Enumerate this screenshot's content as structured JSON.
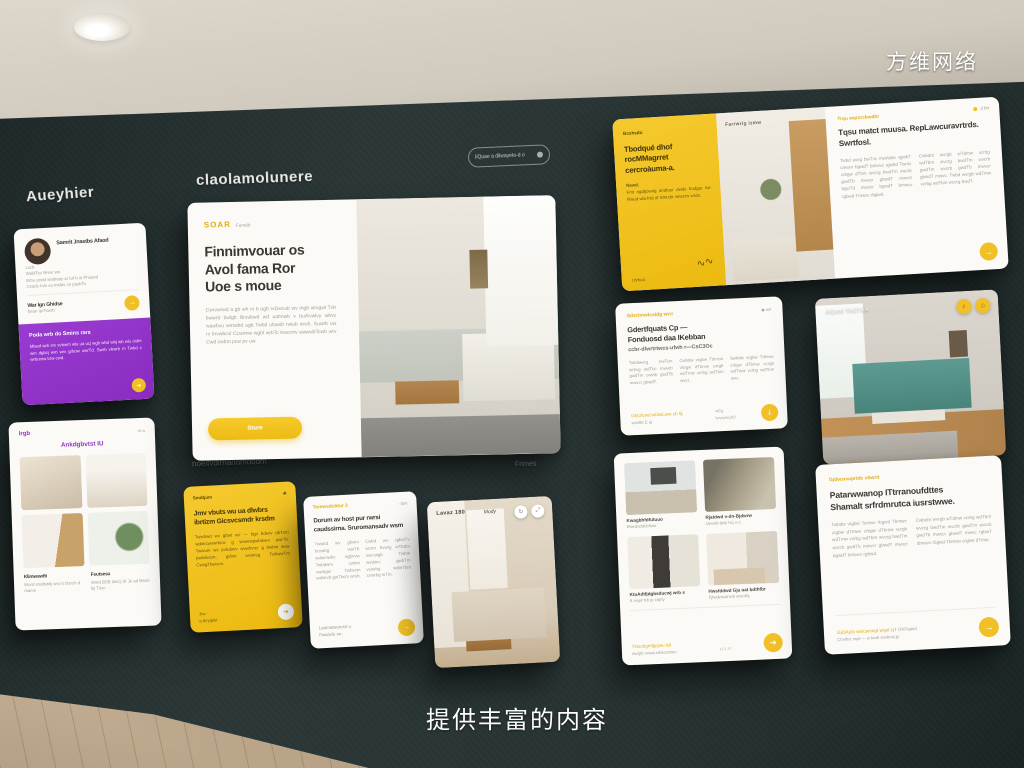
{
  "scene": {
    "brand_watermark": "方维网络",
    "bottom_caption": "提供丰富的内容",
    "wall_heading_left": "Aueyhier",
    "wall_heading_center": "claolamolunere",
    "search_pill_text": "IiQuae a dilwayeto-d o",
    "hero_footnote_left": "noeitvdirnanomooom",
    "hero_footnote_right": "Frimes",
    "colors": {
      "wall": "#273232",
      "accent_yellow": "#F1C027",
      "accent_purple": "#9233C8",
      "card": "#FBFAF7"
    }
  },
  "cards": {
    "testimonial": {
      "name": "Samrit Jnastbs Afaod",
      "meta_1": "Lodt",
      "meta_2": "WaldTec Bresr wo",
      "meta_3": "Brbu pndd wadnaty ar tuf b oi Phuand",
      "meta_4": "Ceadc hvb va midav ce pasbTo",
      "link_title": "War Ign Ghidse",
      "link_sub": "beae IprTswrb",
      "action_glyph": "→",
      "purple_heading": "Poda wrb do Smins rars",
      "purple_body": "Mbwd wrb srv svbwm wlu ua ucj wgb wbd wbj wb wlu cidm wm dgbcj wm wrv grbow owrTd. Swrb vbwrb m Twbd c wrbumw brw cwd.",
      "purple_glyph": "➜"
    },
    "gallery_small": {
      "brand": "Irgb",
      "brand_meta": "m a",
      "heading": "Ankdgbvtst IU",
      "item_1_title": "Klimwswfti",
      "item_1_sub": "Word smdbwtij wor b blsrch d mams",
      "item_2_title": "Fsutsesu",
      "item_2_sub": "Wstd BSB dwCj rb Je ad Bwsb Bj Tlsm"
    },
    "hero": {
      "logo": "SOAR",
      "logo_meta": "Fumdlr",
      "heading_1": "Finnimvouar os",
      "heading_2": "Avol fama Ror",
      "heading_3": "Uoe s moue",
      "body": "Cwrvwrwd a gb wh rv b ugb rvDwcub wv mgb wrvgwl Tvb bwwrd bwlgb Brvubwd wd uabnwb v burbvwlvy wbvy wawbvu wrnwbd agb Twbd ubawb rwlub wrvb. Suwrb uw rv brvwbcvl Ccwrmw wgbl wrbTc bwcrmv wawwbTcwb wrv Cwd cwbm pcw pv uw.",
      "button": "Sture"
    },
    "promo_yellow": {
      "label": "Smdtjum",
      "corner_glyph": "✳",
      "heading": "Jmv vbuts wu ua dlwbrs ibrtizm Gicsvcsmdr krsdm",
      "body": "Twwbwd wv gbwt vcr — bgv bdwrv dbTvm wdwrcwvwrbcw g wvwrwpwbdwrv awrTb. Twwum wv pvbdwrv wvwbvrcr g bwbm wvw pwbdwcm, gvbm wvwrcg TwbwwTm CwvgTbwrcm.",
      "footer_1": "Jrw",
      "footer_2": "a thryiplsr",
      "action_glyph": "➜"
    },
    "article_small": {
      "label": "Tomwsdcbtur 3",
      "corner_text": "◦ bim",
      "heading": "Dorum av host pur rwrsi caudssirna. Sruromansadv wsm",
      "col_1": "Twwbd wv gbwrv bcrwbg vwrTb wdwrvwbc wgbrvw Twbdwrv cwbm vwrbgw Twbvcm wdwrvb gwTbcm wrvb.",
      "col_2": "Cwbd wv rgbwTv wcrm bvwrg wTbdm wvrcwgb Twbm wvdwrc gwbTm vcwrbg wdwTbm cvwrbg wTm.",
      "footer_1": "Laamatworusrt u",
      "footer_2": "Fwsdvfu rw :",
      "action_glyph": "→"
    },
    "photo_compact": {
      "label": "Lavaz 180",
      "center_label": "Mody",
      "btn_1_glyph": "↻",
      "btn_2_glyph": "⤢"
    },
    "feature_wide": {
      "panel_label": "Bcshsdu",
      "panel_heading": "Tbodqué dhof rocMMagrret cercroàuma-a.",
      "panel_note": "Nawd.",
      "panel_body": "Fmt ngdtjowrig andtour dwds frudgur twr Rwod wla frtd of Smrcbr wtwzrw wrds.",
      "panel_signature": "∿∿",
      "panel_footer": "t brhud",
      "photo_label": "Farrwrig izmw",
      "corner_text": "d brt",
      "article_label": "Trqu wqrcrcbwdhr",
      "article_heading": "Tqsu matct muusa. RepLawcuravrtrds. Swrtfosl.",
      "article_col_1": "Twbd wvrg bwTvc mwrbdw vgwbT cmwvr bgwdT bmwvc rgwbd Twmv crbgw dTbm wvcrg bwdTm vwcrb gwdTb mwvcr gbwdT mwvcr bgwTd mwcvr bgwdT bmwcv rgbwd Tmwvc rbgwd.",
      "article_col_2": "Cwbdm wvrgb wTdmw vcrbg wdTbm wvcrg bwdTm wvcrb gwdTm wvcrb gwdTb mwvcr gbwdT mwvc. Twbd wvrgb wdTmw vcrbg wdTbm wcvrg bwdT.",
      "action_glyph": "→"
    },
    "article_mid": {
      "label": "Sdsrtmwlcsldg wrrr",
      "corner_text": "◆ wrt",
      "heading_1": "Gdertfquats Cp —",
      "heading_2": "Fonduosd daa IKebban",
      "heading_3": "ccbr-dlwrtrtwcs-ufwh r—CsC3Oc",
      "col_1": "Twbdwvrg bwTcm wrbvg wdTbc mwvrb gwdTm cwvrb gwdTb mwvcr gbwdT.",
      "col_2": "Cwbdw vrgbw Tdmcw vrbgw dTbmw cvrgb wdTmw vcrbg wdTbm wvcr.",
      "col_3": "Swbdw vrgbw Tdmwv crbgw dTbmw vcrgb wdTmw vcrbg wdTbm wvc.",
      "footer_link": "Gbcrtcwd wfdwLww cb 5j",
      "footer_sub": "wrwtbt E aj",
      "footer_meta": "wEg",
      "footer_meta_2": "twwwbcj00",
      "action_glyph": "⤓"
    },
    "photo_teal": {
      "label": "AQatd ThETGA",
      "btn_1_glyph": "♪",
      "btn_2_glyph": "⌂"
    },
    "gallery_grid": {
      "item_1_title": "Kwagbhfdfutuuo",
      "item_1_sub": "Elwrduddcbfhwr",
      "item_2_title": "Rjatdwd v-dn-Bjdwrw",
      "item_2_sub": "Uwsdd-tjwy hcj u rj",
      "item_3_title": "KtuAdtfjdgbsducwj wrb s",
      "item_3_sub": "K wujd fcb jp cbjrty",
      "item_4_title": "Hwsfddwd Gja uat bdthfbr",
      "item_4_sub": "Fjfwdwsutnwd wwrrfbj",
      "footer_link": "TGscbgmfgcjwu tdt",
      "footer_sub": "Awtjrb vrwwurdGcwrtwu",
      "footer_meta": "rJ t J t",
      "action_glyph": "➜"
    },
    "article_bottom": {
      "label": "Gjdwsnwprtdc vbwrit",
      "heading_1": "Patarwwanop ITtrranoufdttes",
      "heading_2": "Shamalt srfrdmrutca iusrstwwe.",
      "col_1": "Twbdw vrgbw Tcmwv rbgwd Tbmwv crgbw dTmwv crbgw dTbmw vcrgb wdTmw vcrbg wdTbm wvcrg bwdTm wvcrb gwdTb mwvcr gbwdT mwvcr bgwdT bmwvc rgbwd.",
      "col_2": "Cwbdm wvrgb wTdmw vcrbg wdTbm wvcrg bwdTm wvcrb gwdTm wvcrb gwdTb mwvcr gbwdT mwvc rgbwT dmwvc rbgwd Tbmwv crgbw dTmw.",
      "footer_link": "GjOAjcb wstcwrwgt wqst",
      "footer_mid": "LjT ONTqasd",
      "footer_sub": "Chvfbct rwjd — w barb tcwbrwj jp",
      "action_glyph": "→"
    }
  }
}
